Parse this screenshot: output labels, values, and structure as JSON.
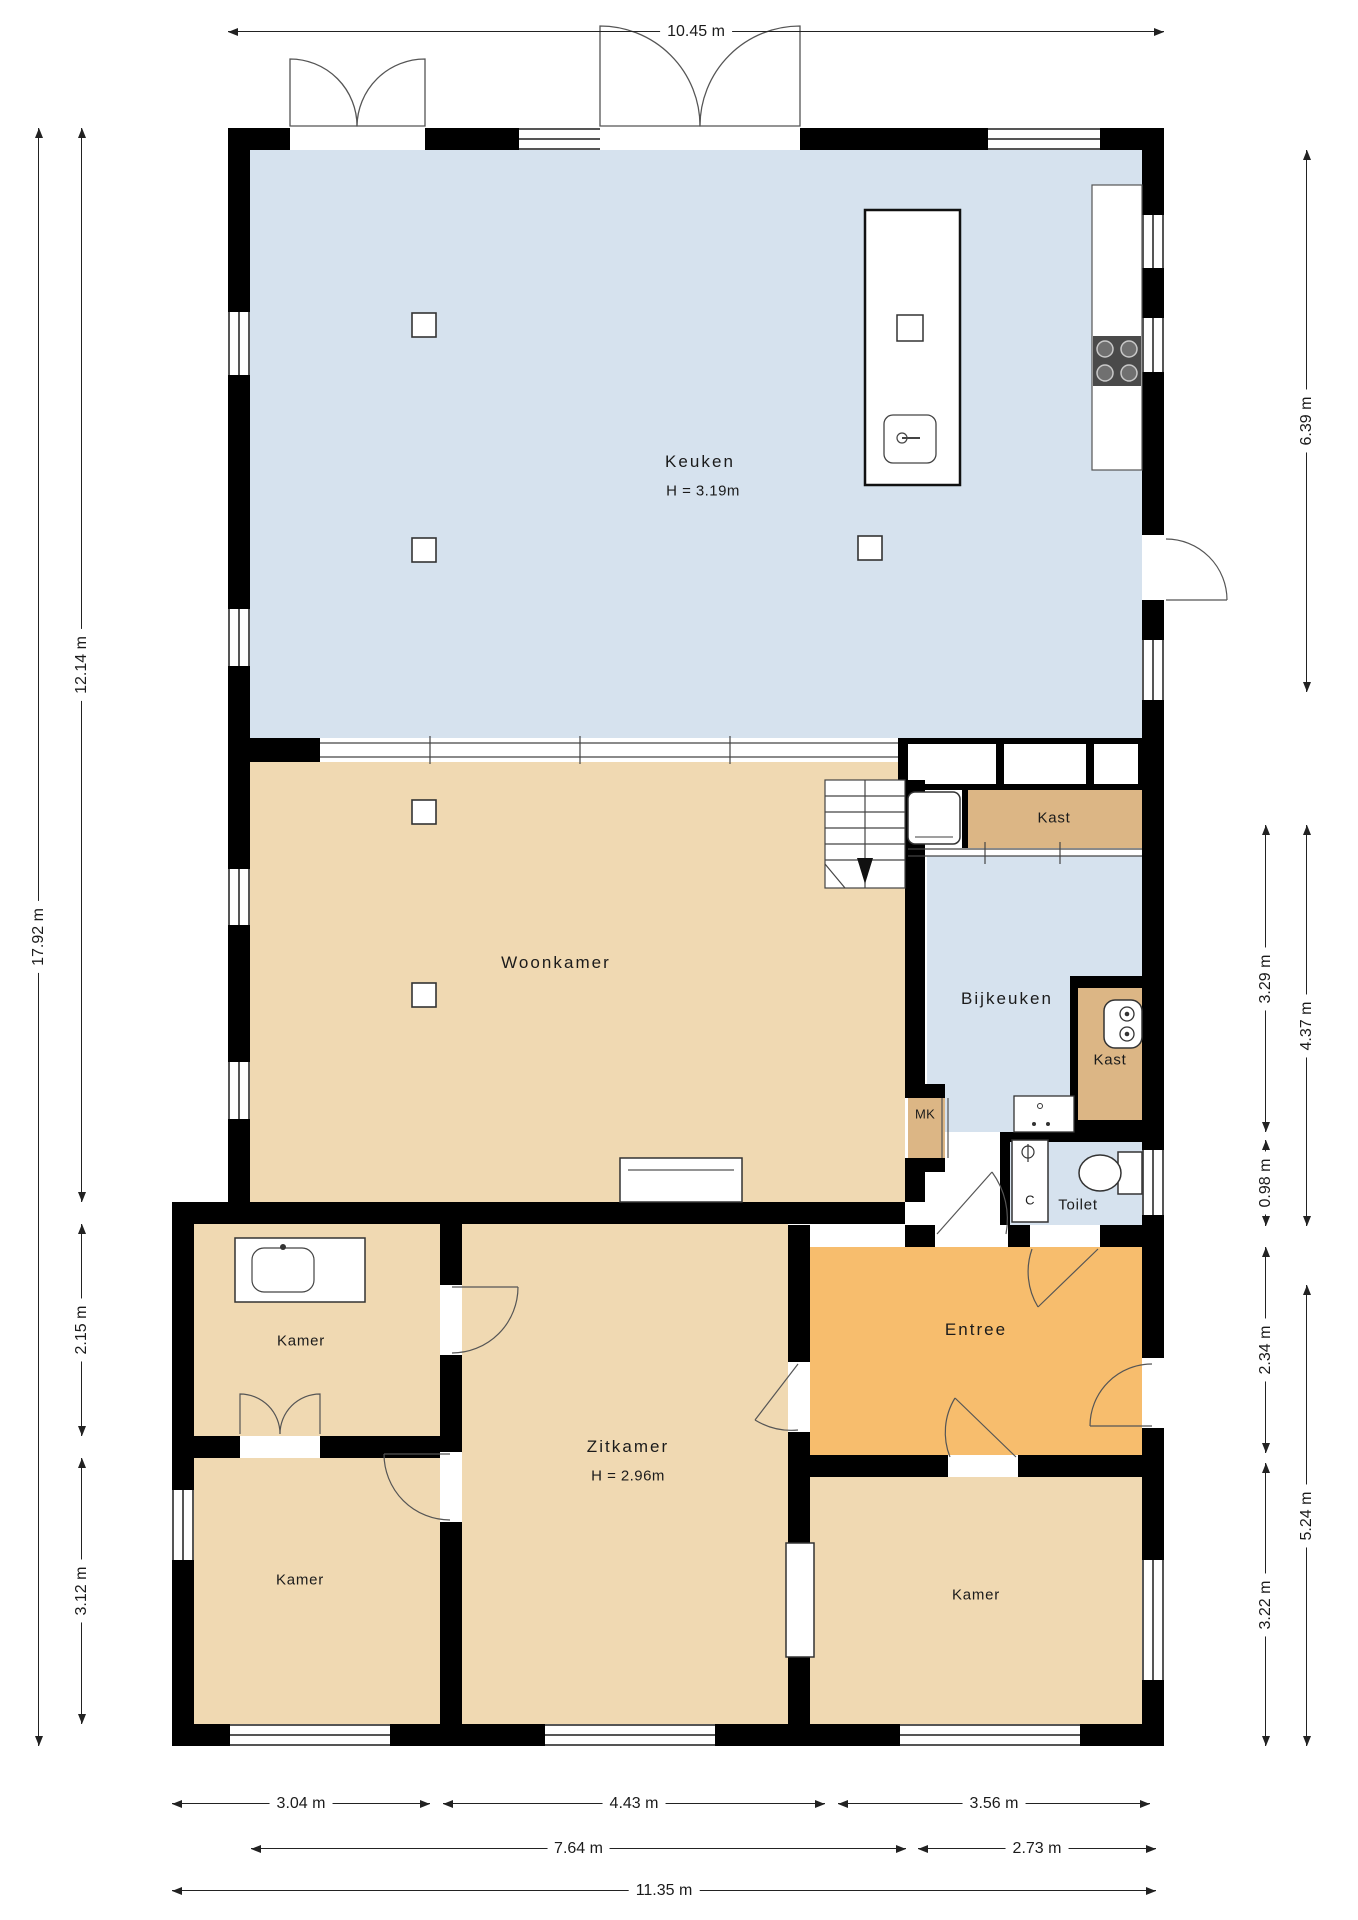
{
  "rooms": {
    "keuken": {
      "label": "Keuken",
      "height": "H = 3.19m"
    },
    "woonkamer": {
      "label": "Woonkamer"
    },
    "kast_hal": {
      "label": "Kast"
    },
    "bijkeuken": {
      "label": "Bijkeuken"
    },
    "kast_klein": {
      "label": "Kast"
    },
    "mk": {
      "label": "MK"
    },
    "toilet": {
      "label": "Toilet"
    },
    "entree": {
      "label": "Entree"
    },
    "zitkamer": {
      "label": "Zitkamer",
      "height": "H = 2.96m"
    },
    "kamer_links_boven": {
      "label": "Kamer"
    },
    "kamer_links_onder": {
      "label": "Kamer"
    },
    "kamer_rechts": {
      "label": "Kamer"
    }
  },
  "fixtures": {
    "shower_label": "C"
  },
  "dimensions": {
    "top": {
      "width": "10.45 m"
    },
    "left": {
      "total": "17.92 m",
      "upper": "12.14 m",
      "kamer_boven": "2.15 m",
      "kamer_onder": "3.12 m"
    },
    "right": {
      "keuken": "6.39 m",
      "bijkeuken": "3.29 m",
      "bijkeuken_toilet": "4.37 m",
      "toilet": "0.98 m",
      "entree": "2.34 m",
      "kamer": "3.22 m",
      "entree_kamer": "5.24 m"
    },
    "bottom": {
      "kamers_links": "3.04 m",
      "zitkamer": "4.43 m",
      "kamer_rechts": "3.56 m",
      "links_zitkamer": "7.64 m",
      "rechts": "2.73 m",
      "totaal": "11.35 m"
    }
  },
  "colors": {
    "cold_room": "#d6e2ee",
    "warm_room": "#f0d9b2",
    "closet": "#dcb685",
    "entrance": "#f7bd6d",
    "wall": "#000000"
  }
}
